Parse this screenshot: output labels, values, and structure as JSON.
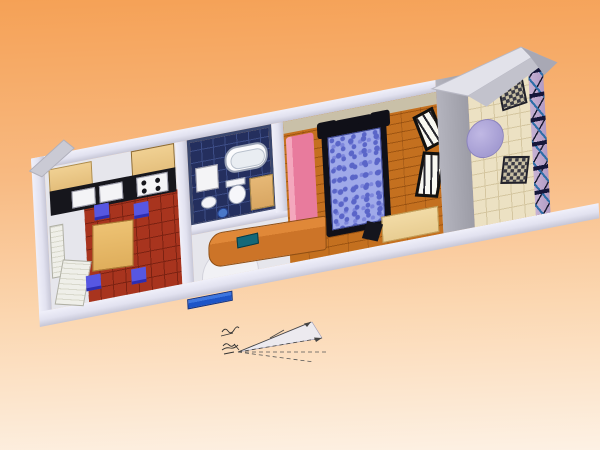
{
  "scene": {
    "description": "3D perspective rendering of a one-bedroom apartment floor plan on an orange gradient backdrop",
    "background_top": "#f5a156",
    "background_mid": "#f8ba82",
    "background_low": "#fbd7b1",
    "background_bottom": "#fdf1e4"
  },
  "palette": {
    "bg_top": "#f5a156",
    "bg_mid": "#f8ba82",
    "bg_low": "#fbd7b1",
    "bg_bottom": "#fdf1e4",
    "wall_white": "#e2e2f0",
    "wall_gray": "#9c9ca6",
    "wall_tan": "#c9c0a8",
    "kitchen_tile": "#a8341e",
    "kitchen_grout": "#7c2212",
    "bath_floor": "#242f5e",
    "bath_line": "#3c4c86",
    "parquet": "#c4701f",
    "parquet_line": "#9e5512",
    "balcony_tile": "#ece1c3",
    "balcony_grout": "#d5c6a0",
    "railing_mauve": "#b29bc4",
    "railing_x": "#2e6ea8",
    "hall_floor": "#e6e6ec",
    "wood_cabinet": "#e3bd7a",
    "wood_table": "#dfae5c",
    "counter_black": "#16161c",
    "chair_blue": "#5757e2",
    "sofa_pink": "#e87b9d",
    "sofa_pink_light": "#f4a7bd",
    "bed_black": "#101018",
    "duvet_light": "#9fa9e9",
    "duvet_dark": "#5a65c8",
    "desk_wood": "#e8cd92",
    "sideboard_wood": "#cc7428",
    "teal_item": "#156878",
    "table_lavender": "#a49cd2",
    "wicker_dark": "#3a3a44",
    "doormat_blue": "#1d55c8"
  },
  "rooms": {
    "kitchen": {
      "label": "kitchen",
      "floor": "red quarry tile",
      "furniture": [
        "upper-cabinets",
        "tall-cabinet",
        "black-counter",
        "sink",
        "stove-top",
        "dining-table",
        "four-blue-chairs",
        "entry-door"
      ]
    },
    "bathroom": {
      "label": "bathroom",
      "floor": "dark navy tile",
      "furniture": [
        "bathtub",
        "toilet",
        "washing-machine",
        "sink",
        "wood-vanity"
      ]
    },
    "hall": {
      "label": "hall",
      "floor": "white",
      "furniture": [
        "wooden-sideboard",
        "door-swing-arc",
        "doormat"
      ]
    },
    "living_bedroom": {
      "label": "living-bedroom",
      "floor": "wood parquet",
      "furniture": [
        "double-bed-blue-duvet",
        "pink-sofa",
        "light-wood-desk",
        "black-chair",
        "glass-folding-door"
      ]
    },
    "balcony": {
      "label": "balcony",
      "floor": "cream stone tile",
      "furniture": [
        "round-lavender-table",
        "two-wicker-chairs",
        "x-brace-railing"
      ]
    }
  },
  "view_indicator": {
    "description": "camera view cone with solid and dashed sight lines, arrowheads and tiny illegible handwritten scribbles",
    "legible_text": false
  }
}
